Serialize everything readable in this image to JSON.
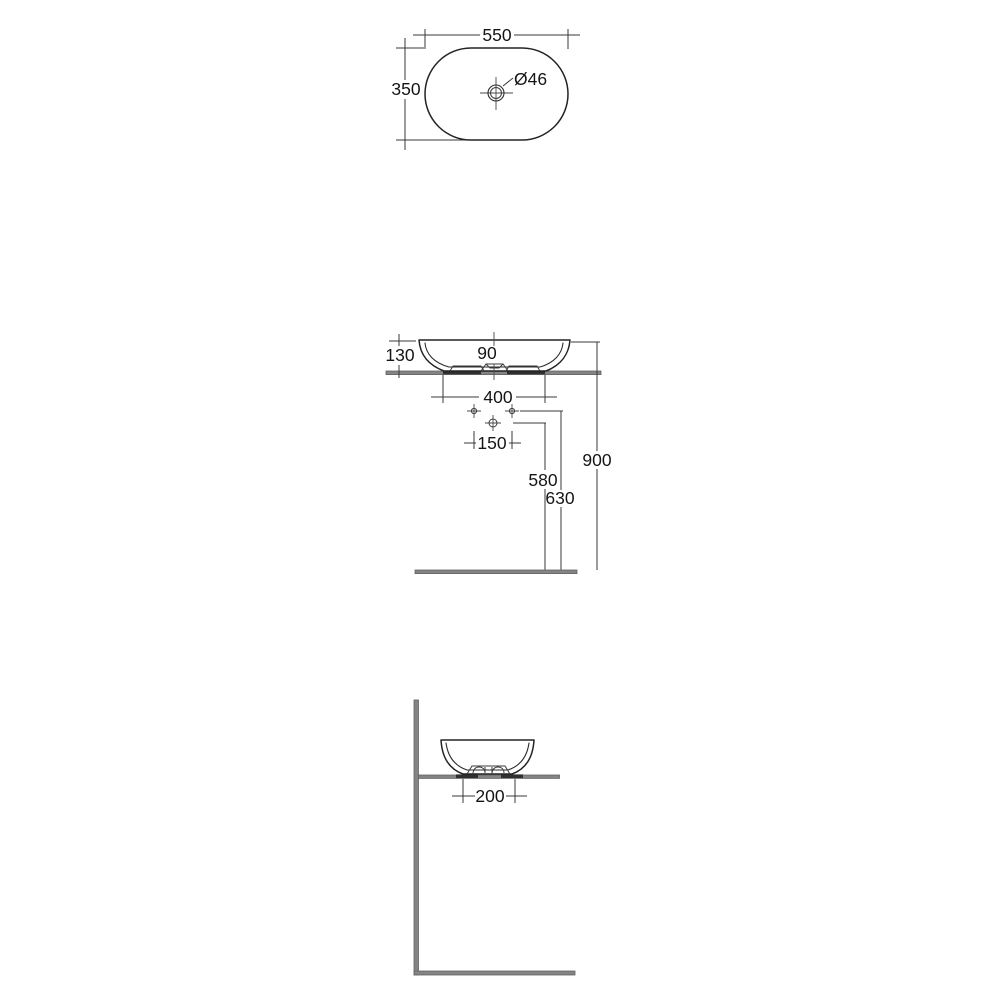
{
  "drawing": {
    "line_color": "#232323",
    "surface_color": "#848484",
    "top_view": {
      "width_label": "550",
      "depth_label": "350",
      "drain_label": "Ø46"
    },
    "front_view": {
      "basin_height_label": "130",
      "center_label": "90",
      "base_width_label": "400",
      "hole_spacing_label": "150",
      "drain_height_label": "580",
      "hole_height_label": "630",
      "worktop_height_label": "900"
    },
    "side_view": {
      "base_depth_label": "200"
    }
  }
}
